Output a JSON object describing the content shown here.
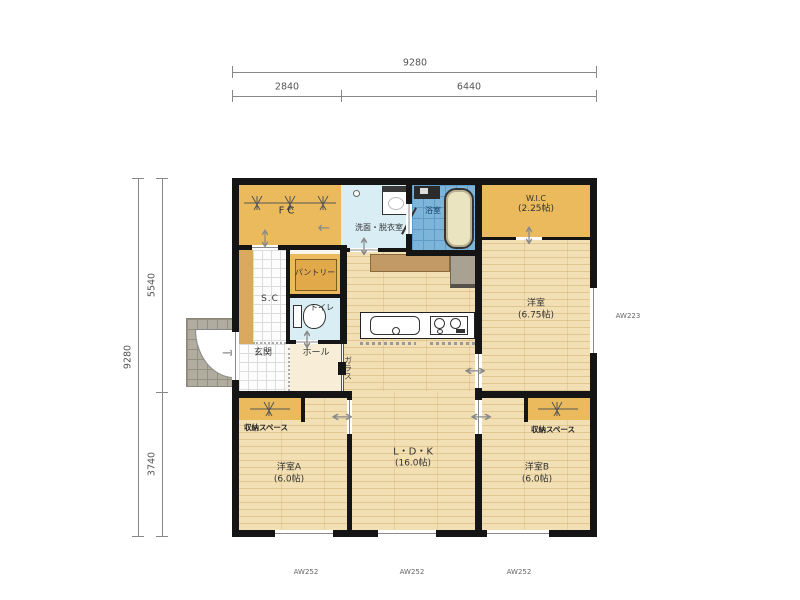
{
  "dimensions": {
    "top": {
      "overall": "9280",
      "seg1": "2840",
      "seg2": "6440"
    },
    "left": {
      "overall": "9280",
      "seg1": "5540",
      "seg2": "3740"
    }
  },
  "windows": {
    "bottom": [
      "AW252",
      "AW252",
      "AW252"
    ],
    "right": "AW223"
  },
  "rooms": {
    "fc": {
      "label": "FC"
    },
    "washroom": {
      "label": "洗面・脱衣室"
    },
    "bath": {
      "label": "浴室"
    },
    "wic": {
      "label": "W.I.C",
      "size": "(2.25帖)"
    },
    "bedroom_main": {
      "label": "洋室",
      "size": "(6.75帖)"
    },
    "pantry": {
      "label": "パントリー"
    },
    "sc": {
      "label": "S.C"
    },
    "toilet": {
      "label": "トイレ"
    },
    "entrance": {
      "label": "玄関"
    },
    "hall": {
      "label": "ホール"
    },
    "ldk": {
      "label": "L・D・K",
      "size": "(16.0帖)"
    },
    "glass": {
      "label": "ガラス"
    },
    "storage_a": {
      "label": "収納スペース"
    },
    "storage_b": {
      "label": "収納スペース"
    },
    "bedroom_a": {
      "label": "洋室A",
      "size": "(6.0帖)"
    },
    "bedroom_b": {
      "label": "洋室B",
      "size": "(6.0帖)"
    }
  },
  "icons": {
    "slide_door_h": "↔",
    "slide_door_v": "↕",
    "entry_arrow": "→",
    "leader_arrow": "←"
  },
  "colors": {
    "closet_orange": "#ebba5c",
    "wood_floor": "#f2dfb4",
    "bath_blue": "#7cb5d9",
    "wet_area_blue": "#d9edf4",
    "hall_cream": "#f8edd6",
    "porch_gray": "#b0ac9f",
    "wall_black": "#151515"
  }
}
